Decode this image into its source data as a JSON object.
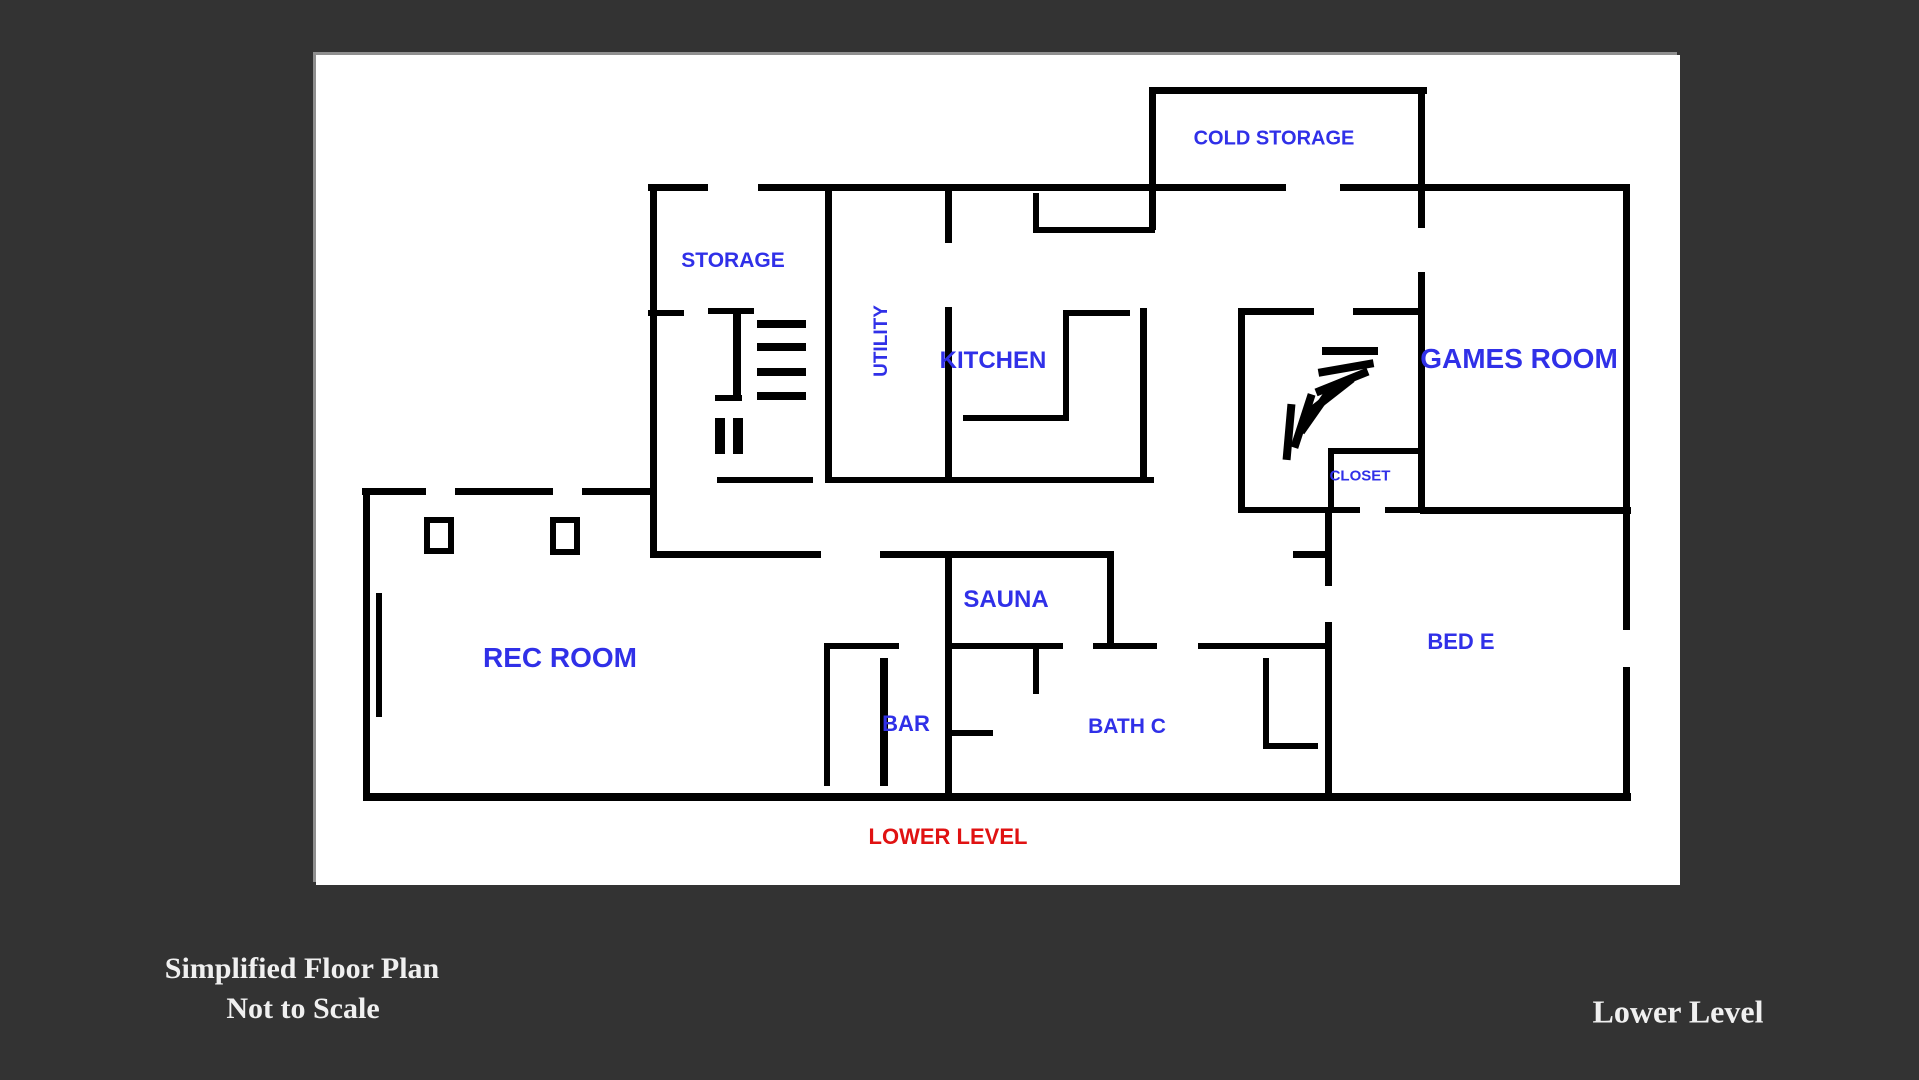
{
  "page": {
    "background_color": "#333333"
  },
  "canvas": {
    "color": "#ffffff"
  },
  "floor_plan": {
    "level_label": "LOWER LEVEL",
    "label_color": "#3030e8",
    "level_label_color": "#e01212",
    "wall_color": "#000000",
    "rooms": {
      "cold_storage": {
        "label": "COLD STORAGE"
      },
      "storage": {
        "label": "STORAGE"
      },
      "utility": {
        "label": "UTILITY"
      },
      "kitchen": {
        "label": "KITCHEN"
      },
      "games_room": {
        "label": "GAMES ROOM"
      },
      "closet": {
        "label": "CLOSET"
      },
      "rec_room": {
        "label": "REC ROOM"
      },
      "sauna": {
        "label": "SAUNA"
      },
      "bar": {
        "label": "BAR"
      },
      "bath_c": {
        "label": "BATH C"
      },
      "bed_e": {
        "label": "BED E"
      }
    }
  },
  "captions": {
    "bottom_left_line1": "Simplified Floor Plan",
    "bottom_left_line2": "Not to Scale",
    "bottom_right": "Lower Level",
    "text_color": "#f0f0f0"
  }
}
